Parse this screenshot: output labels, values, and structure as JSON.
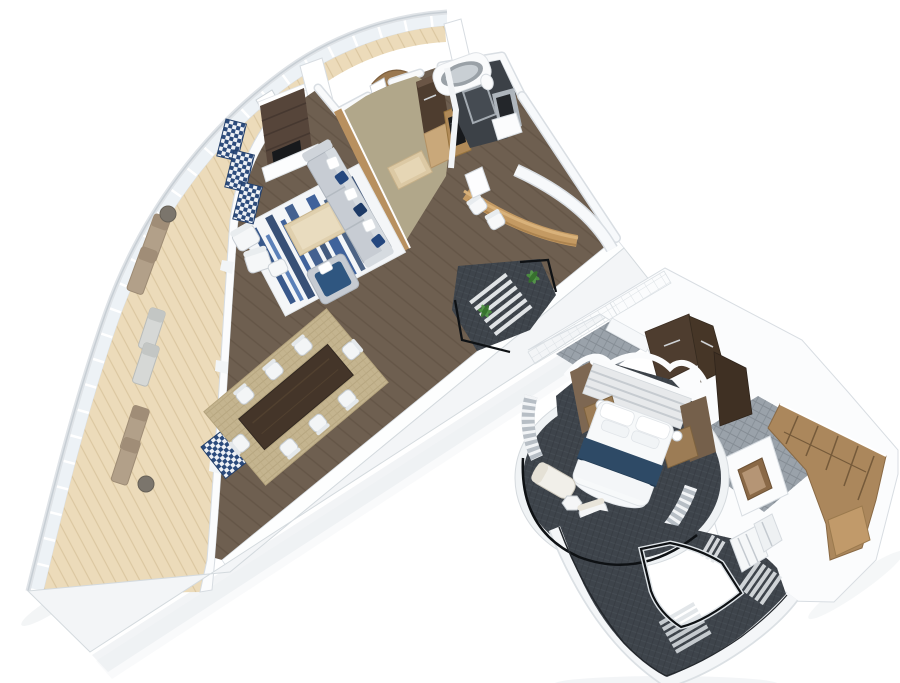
{
  "meta": {
    "kind": "3d-floorplan-render",
    "subject": "Isometric 3D floor plan of a two-wing ship suite",
    "background": "#ffffff"
  },
  "palette": {
    "wall": "#fbfcfd",
    "wall_edge": "#d8dde2",
    "slab": "#f3f5f7",
    "glass": "#edf2f6",
    "deck": "#ecdbba",
    "walnut": "#6e5f50",
    "media_carpet": "#b1a78a",
    "bath_tile_dark": "#3c4147",
    "mosaic_gray": "#9aa2aa",
    "tile_wall": "#f0f2f4",
    "rug_white": "#f4f6f8",
    "rug_blue": "#2c5290",
    "rug_tan": "#c4b48f",
    "table_espresso": "#443529",
    "tv_panel": "#56453a",
    "sofa_gray": "#c7ccd3",
    "navy_accent": "#2f5680",
    "bed_navy": "#2e4a66",
    "cream": "#f1efe9",
    "oak": "#c49a63",
    "oak_shelf": "#ab875c",
    "wood_dark_door": "#4e3d2f",
    "carpet_dark": "#3e444b",
    "stripe_panel": "#e7e9eb",
    "rail_black": "#0e1114",
    "plant_green": "#4c8f3f",
    "shadow": "#e9edf0",
    "lounger_tan": "#b2a089",
    "lounger_light": "#d6d8d6"
  },
  "scene": {
    "main_suite": {
      "name": "main-suite-wing",
      "rooms": [
        {
          "name": "wraparound-balcony",
          "furniture": [
            "lounge-chair",
            "lounge-chair",
            "lounge-chair",
            "lounge-chair",
            "lounge-chair",
            "lounge-chair",
            "round-side-table",
            "round-side-table",
            "curved-wood-chair",
            "open-balcony-door"
          ]
        },
        {
          "name": "living-room",
          "furniture": [
            "wall-art-banner",
            "wall-art-banner",
            "wall-art-banner",
            "tv-panel",
            "tv-screen",
            "media-console",
            "side-table",
            "abstract-blue-rug",
            "coffee-table",
            "sectional-sofa",
            "throw-pillows",
            "chaise-ottoman",
            "armchair",
            "armchair",
            "ottoman",
            "checkered-mat"
          ]
        },
        {
          "name": "dining-area",
          "furniture": [
            "dining-table",
            "dining-chair",
            "dining-chair",
            "dining-chair",
            "dining-chair",
            "dining-chair",
            "dining-chair",
            "dining-chair",
            "dining-chair",
            "woven-rug"
          ]
        },
        {
          "name": "media-lounge",
          "furniture": [
            "tall-wardrobe",
            "sideboard",
            "tv-cabinet",
            "coffee-table"
          ]
        },
        {
          "name": "bathroom",
          "furniture": [
            "oval-bathtub",
            "walk-in-shower",
            "vanity-mirror",
            "toilet"
          ]
        },
        {
          "name": "entry-hall",
          "furniture": [
            "curved-console",
            "desk-chair",
            "desk-chair",
            "entry-stairs",
            "handrail",
            "handrail",
            "potted-plant",
            "potted-plant"
          ]
        }
      ]
    },
    "bedroom_suite": {
      "name": "round-bedroom-wing",
      "rooms": [
        {
          "name": "circular-bedroom",
          "furniture": [
            "king-bed",
            "pillows",
            "navy-bed-runner",
            "striped-headboard",
            "headboard-wing",
            "headboard-wing",
            "nightstand-lamp",
            "nightstand-lamp",
            "wardrobe-door",
            "wardrobe-door",
            "wardrobe-door",
            "curtain",
            "curtain",
            "chaise-lounge",
            "hexagon-table",
            "armchair",
            "curved-railing"
          ]
        },
        {
          "name": "shower-room",
          "furniture": [
            "tiled-walls",
            "mosaic-floor"
          ]
        },
        {
          "name": "closet-bathroom",
          "furniture": [
            "mosaic-floor",
            "open-shelving-unit",
            "framed-mirror-wall"
          ]
        },
        {
          "name": "stairwell",
          "furniture": [
            "switchback-stairs",
            "stair-treads",
            "stair-treads",
            "handrail",
            "louvered-door",
            "louvered-door"
          ]
        }
      ]
    }
  }
}
